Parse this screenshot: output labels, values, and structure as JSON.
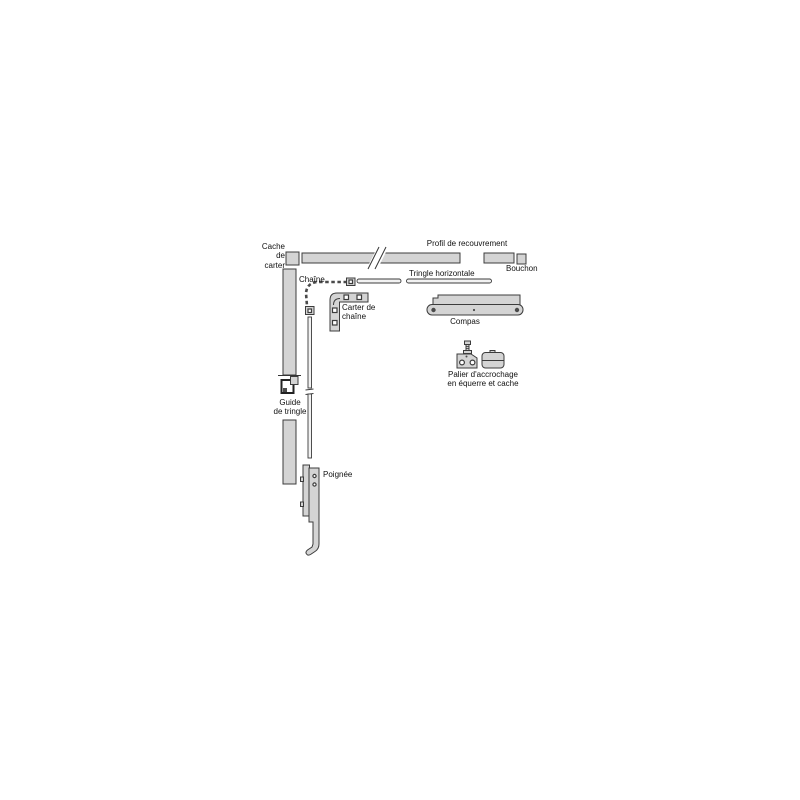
{
  "diagram": {
    "type": "exploded-parts-diagram",
    "subject": "window operator hardware (French part labels)",
    "labels": {
      "cache_de_carter": "Cache de\ncarter",
      "profil_de_recouvrement": "Profil de recouvrement",
      "bouchon": "Bouchon",
      "chaine": "Chaîne",
      "tringle_horizontale": "Tringle horizontale",
      "carter_de_chaine": "Carter de\nchaîne",
      "compas": "Compas",
      "palier": "Palier d'accrochage\nen équerre  et cache",
      "guide_de_tringle": "Guide\nde tringle",
      "poignee": "Poignée"
    }
  },
  "colors": {
    "background": "#ffffff",
    "part-fill": "#d4d4d4",
    "part-stroke": "#3c3c3c",
    "chain-stroke": "#4a4a4a",
    "label-text": "#111111"
  }
}
